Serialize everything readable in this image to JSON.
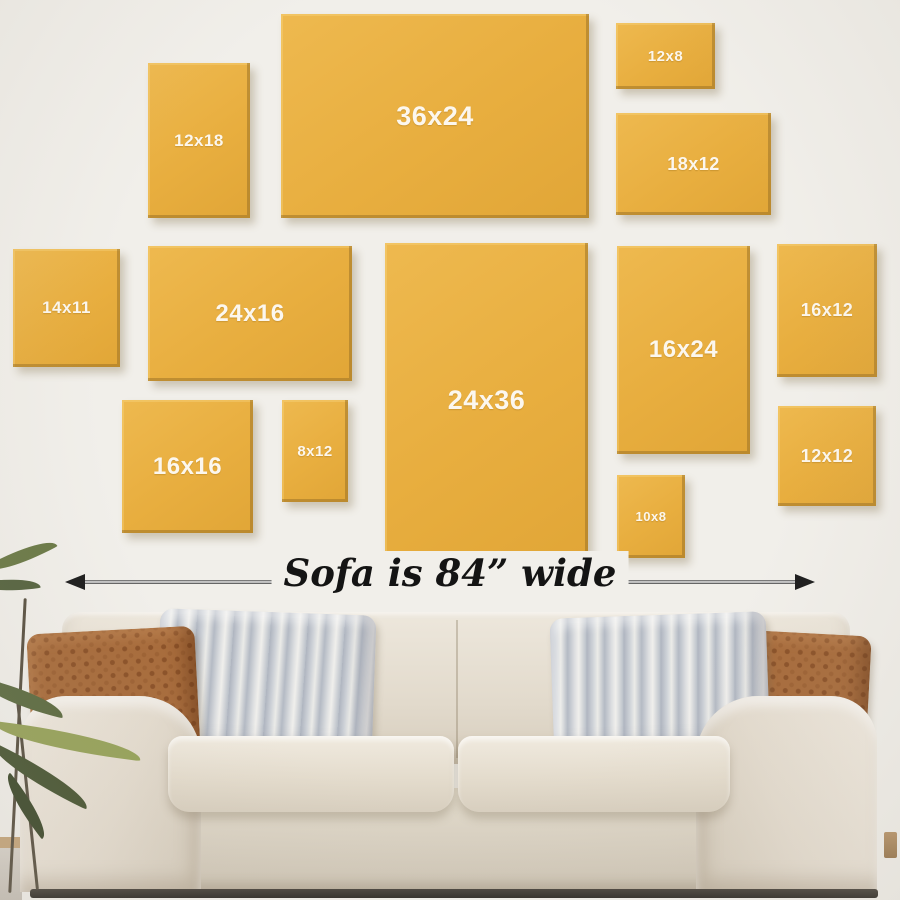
{
  "meta": {
    "title": "Canvas print size comparison above an 84-inch sofa"
  },
  "palette": {
    "wall": "#f1efea",
    "frame": "#e8ae3f",
    "frame_text": "#fcf7ee",
    "arrow": "#1d1d1d",
    "sofa_fabric": "#e4dccf",
    "pillow_rust": "#a86c3c",
    "pillow_stripe": "#c3c8cf"
  },
  "frames": {
    "items": [
      {
        "id": "12x18",
        "label": "12x18",
        "x": 148,
        "y": 63,
        "w": 102,
        "h": 155,
        "fs": 17
      },
      {
        "id": "36x24",
        "label": "36x24",
        "x": 281,
        "y": 14,
        "w": 308,
        "h": 204,
        "fs": 27
      },
      {
        "id": "12x8",
        "label": "12x8",
        "x": 616,
        "y": 23,
        "w": 99,
        "h": 66,
        "fs": 15
      },
      {
        "id": "18x12",
        "label": "18x12",
        "x": 616,
        "y": 113,
        "w": 155,
        "h": 102,
        "fs": 18
      },
      {
        "id": "14x11",
        "label": "14x11",
        "x": 13,
        "y": 249,
        "w": 107,
        "h": 118,
        "fs": 17
      },
      {
        "id": "24x16",
        "label": "24x16",
        "x": 148,
        "y": 246,
        "w": 204,
        "h": 135,
        "fs": 24
      },
      {
        "id": "24x36",
        "label": "24x36",
        "x": 385,
        "y": 243,
        "w": 203,
        "h": 314,
        "fs": 27
      },
      {
        "id": "16x24",
        "label": "16x24",
        "x": 617,
        "y": 246,
        "w": 133,
        "h": 208,
        "fs": 24
      },
      {
        "id": "16x12",
        "label": "16x12",
        "x": 777,
        "y": 244,
        "w": 100,
        "h": 133,
        "fs": 18
      },
      {
        "id": "16x16",
        "label": "16x16",
        "x": 122,
        "y": 400,
        "w": 131,
        "h": 133,
        "fs": 24
      },
      {
        "id": "8x12",
        "label": "8x12",
        "x": 282,
        "y": 400,
        "w": 66,
        "h": 102,
        "fs": 15
      },
      {
        "id": "10x8",
        "label": "10x8",
        "x": 617,
        "y": 475,
        "w": 68,
        "h": 83,
        "fs": 13
      },
      {
        "id": "12x12",
        "label": "12x12",
        "x": 778,
        "y": 406,
        "w": 98,
        "h": 100,
        "fs": 18
      }
    ]
  },
  "dimension": {
    "label": "Sofa is 84” wide",
    "arrow_x1": 65,
    "arrow_x2": 815,
    "arrow_y": 582
  }
}
